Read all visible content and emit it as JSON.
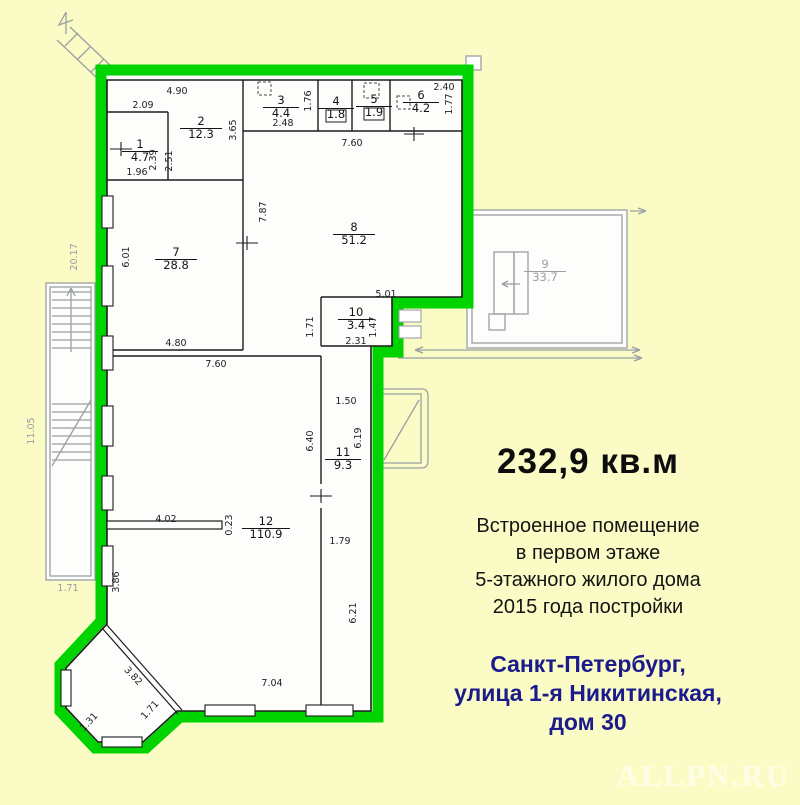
{
  "info": {
    "area": "232,9 кв.м",
    "description_lines": [
      "Встроенное помещение",
      "в первом этаже",
      "5-этажного жилого дома",
      "2015 года постройки"
    ],
    "address_lines": [
      "Санкт-Петербург,",
      "улица 1-я Никитинская,",
      "дом 30"
    ],
    "address_color": "#1b1b8c",
    "watermark": "ALLPN.RU"
  },
  "colors": {
    "background": "#fbfbc6",
    "highlight_green": "#00d400",
    "walls": "#1c1c1c",
    "external_gray": "#9aa0a4"
  },
  "plan": {
    "rooms": [
      {
        "number": "1",
        "area": "4.7",
        "x": 140,
        "y": 148
      },
      {
        "number": "2",
        "area": "12.3",
        "x": 201,
        "y": 125
      },
      {
        "number": "3",
        "area": "4.4",
        "x": 281,
        "y": 104
      },
      {
        "number": "4",
        "area": "1.8",
        "x": 336,
        "y": 105
      },
      {
        "number": "5",
        "area": "1.9",
        "x": 374,
        "y": 103
      },
      {
        "number": "6",
        "area": "4.2",
        "x": 421,
        "y": 99
      },
      {
        "number": "7",
        "area": "28.8",
        "x": 176,
        "y": 256
      },
      {
        "number": "8",
        "area": "51.2",
        "x": 354,
        "y": 231
      },
      {
        "number": "9",
        "area": "33.7",
        "x": 545,
        "y": 268,
        "external": true
      },
      {
        "number": "10",
        "area": "3.4",
        "x": 356,
        "y": 316
      },
      {
        "number": "11",
        "area": "9.3",
        "x": 343,
        "y": 456
      },
      {
        "number": "12",
        "area": "110.9",
        "x": 266,
        "y": 525
      }
    ],
    "dimensions": [
      {
        "t": "4.90",
        "x": 177,
        "y": 94
      },
      {
        "t": "2.09",
        "x": 143,
        "y": 108
      },
      {
        "t": "3.65",
        "x": 236,
        "y": 130,
        "r": -90
      },
      {
        "t": "2.48",
        "x": 283,
        "y": 126
      },
      {
        "t": "1.76",
        "x": 311,
        "y": 101,
        "r": -90
      },
      {
        "t": "2.40",
        "x": 444,
        "y": 90
      },
      {
        "t": "1.77",
        "x": 452,
        "y": 104,
        "r": -90
      },
      {
        "t": "7.60",
        "x": 352,
        "y": 146
      },
      {
        "t": "1.96",
        "x": 137,
        "y": 175
      },
      {
        "t": "2.39",
        "x": 156,
        "y": 160,
        "r": -90
      },
      {
        "t": "2.51",
        "x": 172,
        "y": 161,
        "r": -90
      },
      {
        "t": "7.87",
        "x": 266,
        "y": 212,
        "r": -90
      },
      {
        "t": "6.01",
        "x": 129,
        "y": 257,
        "r": -90
      },
      {
        "t": "4.80",
        "x": 176,
        "y": 346
      },
      {
        "t": "7.60",
        "x": 216,
        "y": 367
      },
      {
        "t": "5.01",
        "x": 386,
        "y": 297
      },
      {
        "t": "1.71",
        "x": 313,
        "y": 327,
        "r": -90
      },
      {
        "t": "1.47",
        "x": 376,
        "y": 327,
        "r": -90
      },
      {
        "t": "2.31",
        "x": 356,
        "y": 344
      },
      {
        "t": "1.50",
        "x": 346,
        "y": 404
      },
      {
        "t": "6.40",
        "x": 313,
        "y": 441,
        "r": -90
      },
      {
        "t": "6.19",
        "x": 361,
        "y": 438,
        "r": -90
      },
      {
        "t": "4.02",
        "x": 166,
        "y": 522
      },
      {
        "t": "0.23",
        "x": 232,
        "y": 525,
        "r": -90
      },
      {
        "t": "1.79",
        "x": 340,
        "y": 544
      },
      {
        "t": "3.86",
        "x": 119,
        "y": 582,
        "r": -90
      },
      {
        "t": "6.21",
        "x": 356,
        "y": 613,
        "r": -90
      },
      {
        "t": "7.04",
        "x": 272,
        "y": 686
      },
      {
        "t": "3.82",
        "x": 131,
        "y": 678,
        "r": 47
      },
      {
        "t": "1.31",
        "x": 91,
        "y": 724,
        "r": -47
      },
      {
        "t": "1.71",
        "x": 152,
        "y": 712,
        "r": -47
      },
      {
        "t": "20.17",
        "x": 77,
        "y": 257,
        "r": -90,
        "g": true
      },
      {
        "t": "11.05",
        "x": 34,
        "y": 431,
        "r": -90,
        "g": true
      },
      {
        "t": "1.71",
        "x": 68,
        "y": 591,
        "g": true
      }
    ]
  }
}
